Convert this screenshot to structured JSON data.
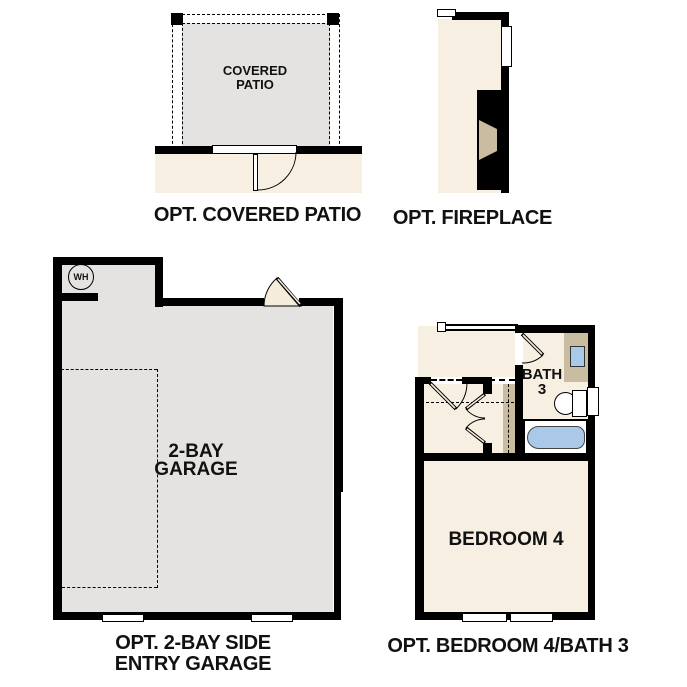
{
  "patio": {
    "room_label_line1": "COVERED",
    "room_label_line2": "PATIO",
    "caption": "OPT. COVERED PATIO"
  },
  "fireplace": {
    "caption": "OPT. FIREPLACE"
  },
  "garage": {
    "water_heater_label": "WH",
    "room_label_line1": "2-BAY",
    "room_label_line2": "GARAGE",
    "caption_line1": "OPT. 2-BAY SIDE",
    "caption_line2": "ENTRY GARAGE"
  },
  "bedroom": {
    "bath_label_line1": "BATH",
    "bath_label_line2": "3",
    "room_label": "BEDROOM 4",
    "caption": "OPT. BEDROOM 4/BATH 3"
  },
  "colors": {
    "wall": "#000000",
    "garage_fill": "#e4e3e1",
    "interior_fill": "#f7f0e2",
    "door_fill": "#f5ecdc",
    "cabinet_tan": "#c9bca0",
    "sink_blue": "#a9c9e9",
    "tub_blue": "#aac9e8"
  }
}
